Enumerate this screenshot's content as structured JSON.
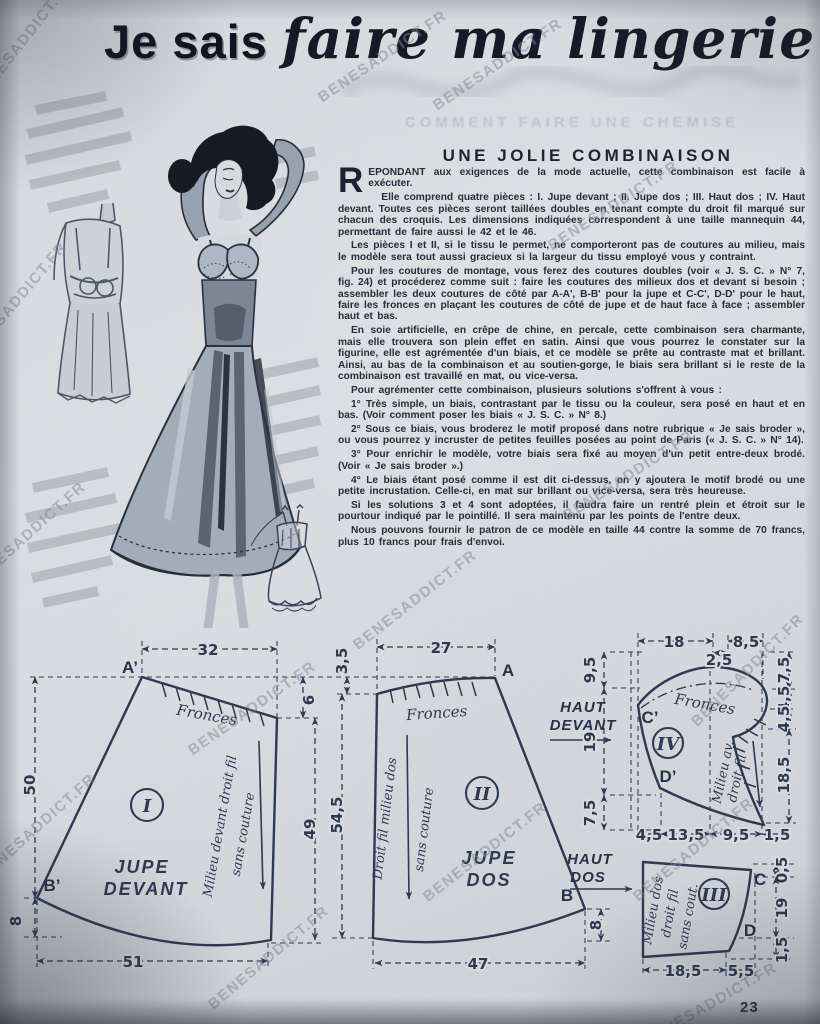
{
  "page": {
    "watermark": "BENESADDICT.FR"
  },
  "header": {
    "title_bold": "Je sais",
    "title_script": "faire ma lingerie",
    "ghost_line": "COMMENT FAIRE UNE CHEMISE"
  },
  "article": {
    "heading": "UNE JOLIE COMBINAISON",
    "dropcap": "R",
    "paragraphs": [
      "EPONDANT aux exigences de la mode actuelle, cette combinaison est facile à exécuter.",
      "Elle comprend quatre pièces : I. Jupe devant ; II. Jupe dos ; III. Haut dos ; IV. Haut devant. Toutes ces pièces seront taillées doubles en tenant compte du droit fil marqué sur chacun des croquis. Les dimensions indiquées correspondent à une taille mannequin 44, permettant de faire aussi le 42 et le 46.",
      "Les pièces I et II, si le tissu le permet, ne comporteront pas de coutures au milieu, mais le modèle sera tout aussi gracieux si la largeur du tissu employé vous y contraint.",
      "Pour les coutures de montage, vous ferez des coutures doubles (voir « J. S. C. » N° 7, fig. 24) et procéderez comme suit : faire les coutures des milieux dos et devant si besoin ; assembler les deux coutures de côté par A-A', B-B' pour la jupe et C-C', D-D' pour le haut, faire les fronces en plaçant les coutures de côté de jupe et de haut face à face ; assembler haut et bas.",
      "En soie artificielle, en crêpe de chine, en percale, cette combinaison sera charmante, mais elle trouvera son plein effet en satin. Ainsi que vous pourrez le constater sur la figurine, elle est agrémentée d'un biais, et ce modèle se prête au contraste mat et brillant. Ainsi, au bas de la combinaison et au soutien-gorge, le biais sera brillant si le reste de la combinaison est travaillé en mat, ou vice-versa.",
      "Pour agrémenter cette combinaison, plusieurs solutions s'offrent à vous :",
      "1° Très simple, un biais, contrastant par le tissu ou la couleur, sera posé en haut et en bas. (Voir comment poser les biais « J. S. C. » N° 8.)",
      "2° Sous ce biais, vous broderez le motif proposé dans notre rubrique « Je sais broder », ou vous pourrez y incruster de petites feuilles posées au point de Paris (« J. S. C. » N° 14).",
      "3° Pour enrichir le modèle, votre biais sera fixé au moyen d'un petit entre-deux brodé. (Voir « Je sais broder ».)",
      "4° Le biais étant posé comme il est dit ci-dessus, on y ajoutera le motif brodé ou une petite incrustation. Celle-ci, en mat sur brillant ou vice-versa, sera très heureuse.",
      "Si les solutions 3 et 4 sont adoptées, il faudra faire un rentré plein et étroit sur le pourtour indiqué par le pointillé. Il sera maintenu par les points de l'entre deux.",
      "Nous pouvons fournir le patron de ce modèle en taille 44 contre la somme de 70 francs, plus 10 francs pour frais d'envoi."
    ]
  },
  "diagram": {
    "fronces": "Fronces",
    "haut": "HAUT",
    "devant": "DEVANT",
    "dos": "DOS",
    "p1": {
      "roman": "I",
      "name1": "JUPE",
      "name2": "DEVANT",
      "a": "A’",
      "b": "B’",
      "top": "32",
      "drop": "6",
      "left": "50",
      "left_low": "8",
      "right": "49",
      "bottom": "51",
      "grain1": "Milieu devant droit fil",
      "grain2": "sans couture"
    },
    "p2": {
      "roman": "II",
      "name1": "JUPE",
      "name2": "DOS",
      "a": "A",
      "b": "B",
      "top": "27",
      "drop": "3,5",
      "left": "54,5",
      "bottom": "47",
      "b_drop": "8",
      "grain1": "Droit fil milieu dos",
      "grain2": "sans couture"
    },
    "mid": {
      "d1": "9,5",
      "d2": "19",
      "d3": "7,5"
    },
    "p4": {
      "roman": "IV",
      "c": "C’",
      "d": "D’",
      "top1": "18",
      "top2": "2,5",
      "top3": "8,5",
      "r1": "7,5",
      "r2": "4,5",
      "r3": "4,5",
      "r4": "18,5",
      "b1": "4,5",
      "b2": "13,5",
      "b3": "9,5",
      "b4": "1,5",
      "grain1": "Milieu av.",
      "grain2": "droit fil"
    },
    "p3": {
      "roman": "III",
      "c": "C",
      "d": "D",
      "r1": "0,5",
      "r2": "19",
      "r3": "1,5",
      "b1": "18,5",
      "b2": "5,5",
      "grain1": "Milieu dos",
      "grain2": "droit fil",
      "grain3": "sans cout."
    }
  },
  "footer": {
    "page_number": "23"
  }
}
